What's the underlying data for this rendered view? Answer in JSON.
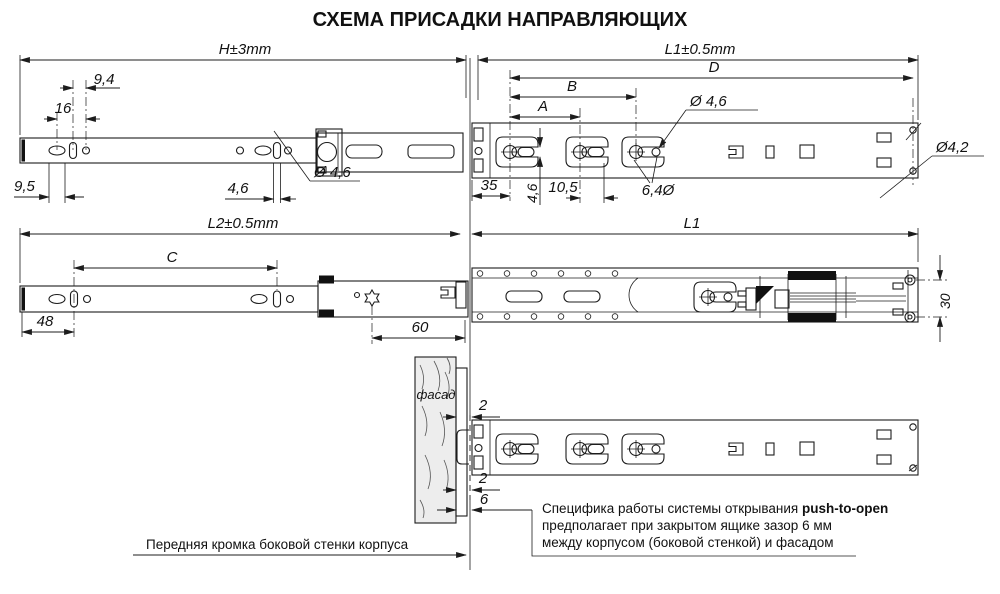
{
  "title": "СХЕМА ПРИСАДКИ НАПРАВЛЯЮЩИХ",
  "colors": {
    "line": "#1c1c1c",
    "facade_fill": "#ededed",
    "black_fill": "#111111"
  },
  "views": {
    "top_left": {
      "overall": "H±3mm",
      "d9_4": "9,4",
      "d16": "16",
      "d9_5": "9,5",
      "d4_6": "4,6",
      "dia4_6": "Ø 4,6"
    },
    "top_right": {
      "overall": "L1±0.5mm",
      "dD": "D",
      "dB": "B",
      "dA": "A",
      "dia4_6": "Ø 4,6",
      "dia4_2": "Ø4,2",
      "d35": "35",
      "d4_6": "4,6",
      "d10_5": "10,5",
      "d6_4": "6,4Ø"
    },
    "middle_left": {
      "overall": "L2±0.5mm",
      "dC": "C",
      "d48": "48",
      "d60": "60"
    },
    "middle_right": {
      "overall": "L1",
      "d30": "30"
    },
    "bottom": {
      "facade": "фасад",
      "gap1": "2",
      "gap2": "2",
      "gap3": "6"
    }
  },
  "notes": {
    "front_edge": "Передняя кромка боковой стенки корпуса",
    "push1": "Специфика работы системы открывания ",
    "push1b": "push-to-open",
    "push2": "предполагает при закрытом ящике зазор 6 мм",
    "push3": "между корпусом (боковой стенкой) и фасадом"
  }
}
